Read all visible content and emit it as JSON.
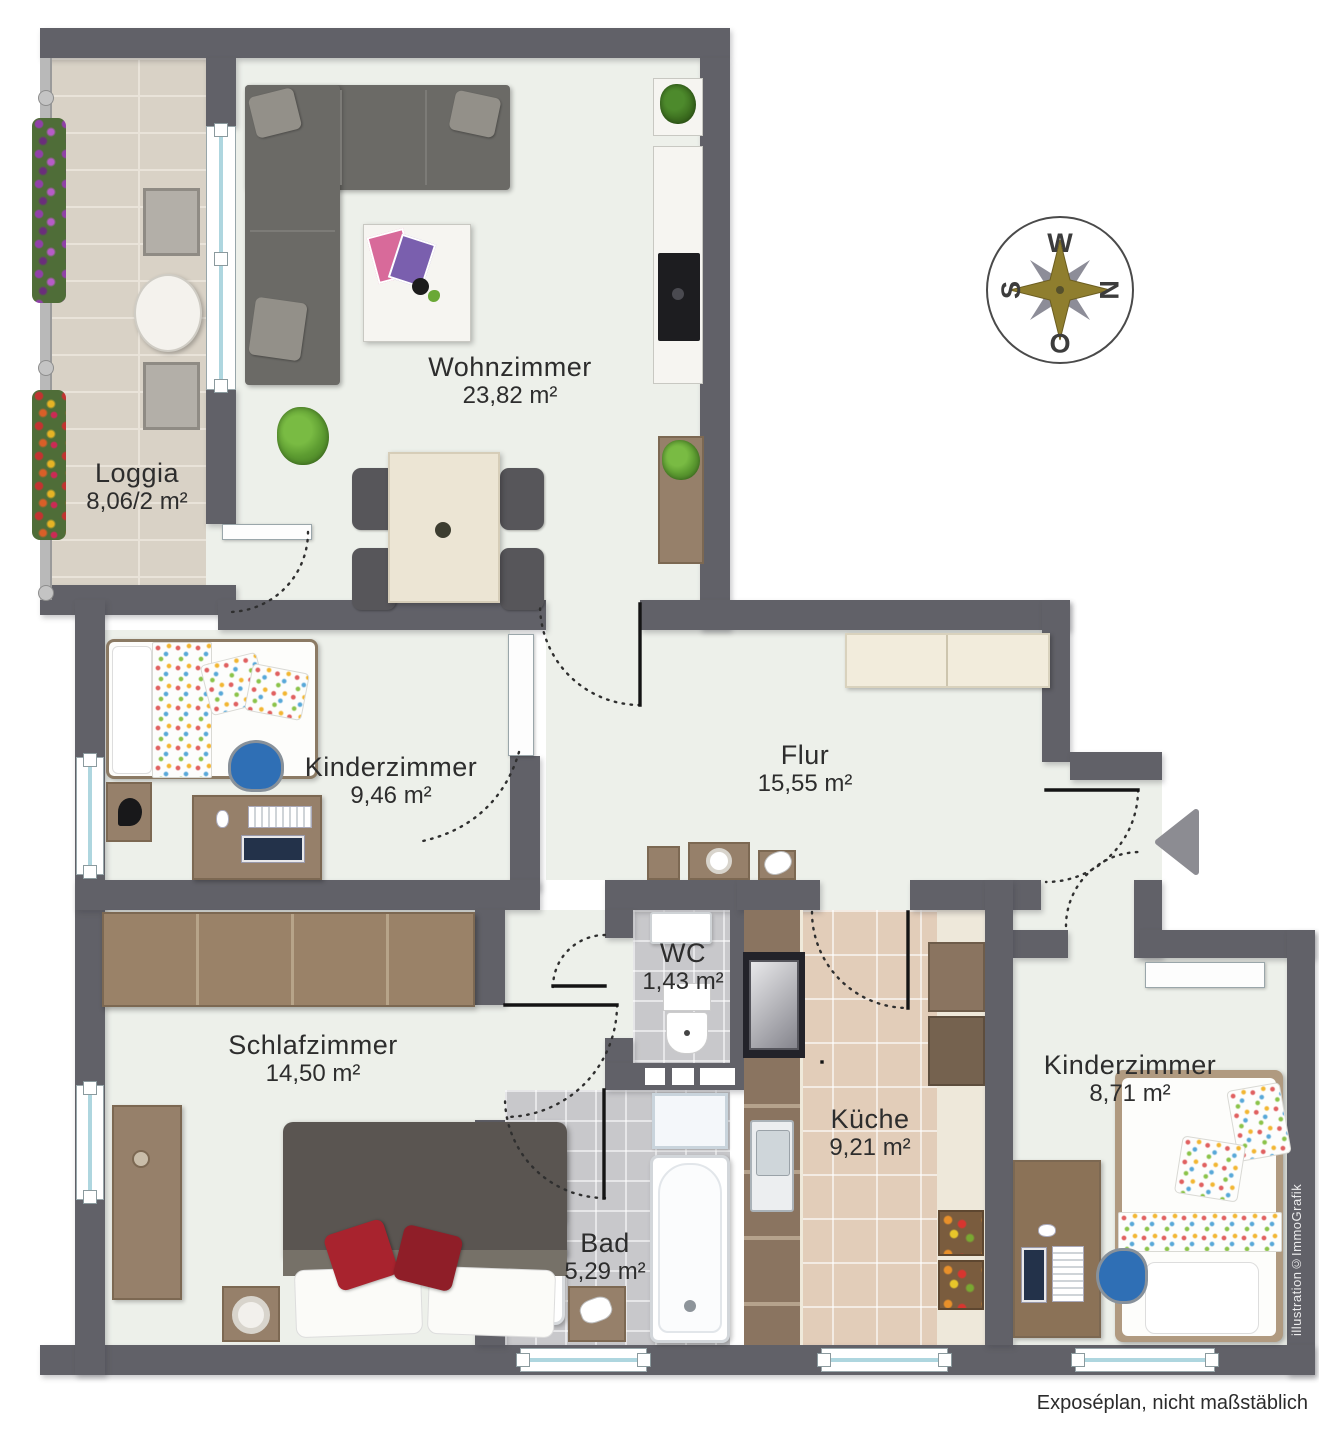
{
  "plan": {
    "title": "Exposéplan Wohnung Grundriss",
    "rooms": [
      {
        "name": "Wohnzimmer",
        "area": "23,82 m²"
      },
      {
        "name": "Loggia",
        "area": "8,06/2 m²"
      },
      {
        "name": "Kinderzimmer",
        "area": "9,46 m²"
      },
      {
        "name": "Flur",
        "area": "15,55 m²"
      },
      {
        "name": "WC",
        "area": "1,43 m²"
      },
      {
        "name": "Schlafzimmer",
        "area": "14,50 m²"
      },
      {
        "name": "Bad",
        "area": "5,29 m²"
      },
      {
        "name": "Küche",
        "area": "9,21 m²"
      },
      {
        "name": "Kinderzimmer",
        "area": "8,71 m²"
      }
    ],
    "compass": {
      "top": "W",
      "right": "N",
      "left": "S",
      "bottom": "O"
    },
    "footer_note": "Exposéplan, nicht maßstäblich",
    "credit": "illustration©ImmoGrafik",
    "colors": {
      "wall": "#616168",
      "floor": "#edf0ea",
      "loggia_tile": "#d9d2c6",
      "bath_tile": "#c8c8cb",
      "kitchen_tile": "#e2cdb9",
      "wood": "#96806a",
      "accent_red": "#a8232e",
      "plant_green": "#5d9c31",
      "chair_blue": "#2f6fb5",
      "compass_gold": "#8f7e2e",
      "compass_gray": "#8d8d98"
    }
  }
}
